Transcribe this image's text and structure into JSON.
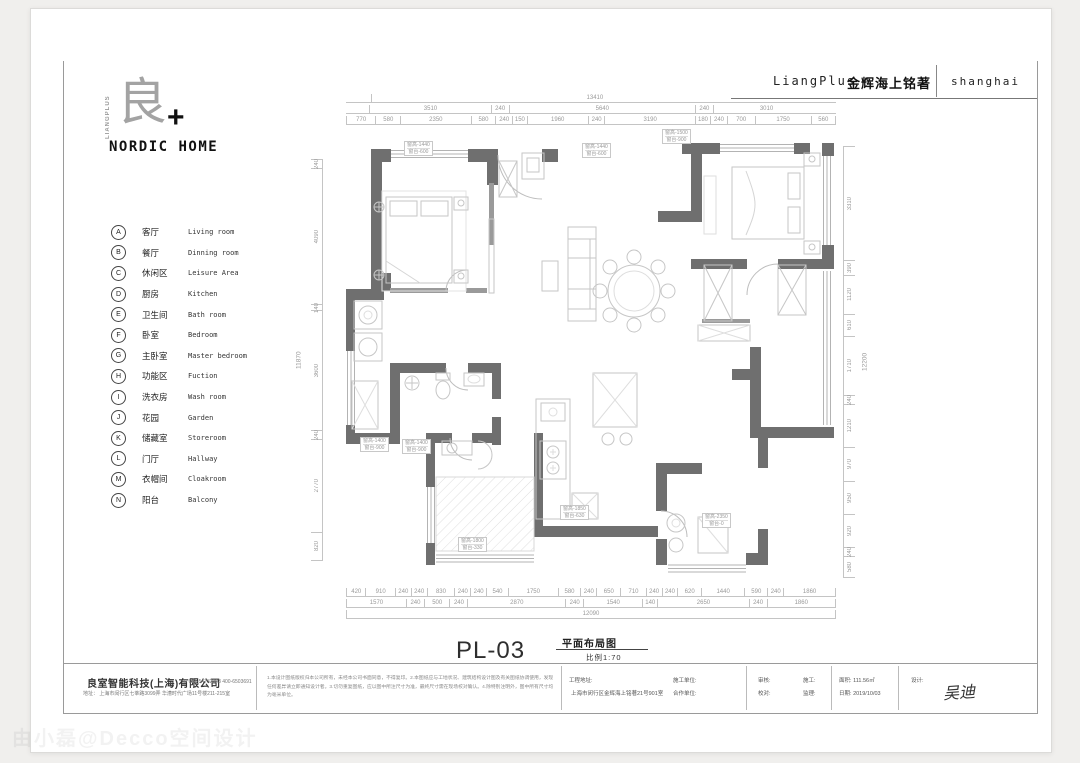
{
  "header": {
    "brand": "LiangPlus",
    "project": "金辉海上铭著",
    "city": "shanghai"
  },
  "logo": {
    "vertical": "LIANGPLUS",
    "glyph": "良",
    "plus": "+",
    "wordmark": "NORDIC HOME"
  },
  "legend": {
    "items": [
      {
        "key": "A",
        "cn": "客厅",
        "en": "Living room"
      },
      {
        "key": "B",
        "cn": "餐厅",
        "en": "Dinning room"
      },
      {
        "key": "C",
        "cn": "休闲区",
        "en": "Leisure Area"
      },
      {
        "key": "D",
        "cn": "厨房",
        "en": "Kitchen"
      },
      {
        "key": "E",
        "cn": "卫生间",
        "en": "Bath room"
      },
      {
        "key": "F",
        "cn": "卧室",
        "en": "Bedroom"
      },
      {
        "key": "G",
        "cn": "主卧室",
        "en": "Master bedroom"
      },
      {
        "key": "H",
        "cn": "功能区",
        "en": "Fuction"
      },
      {
        "key": "I",
        "cn": "洗衣房",
        "en": "Wash room"
      },
      {
        "key": "J",
        "cn": "花园",
        "en": "Garden"
      },
      {
        "key": "K",
        "cn": "储藏室",
        "en": "Storeroom"
      },
      {
        "key": "L",
        "cn": "门厅",
        "en": "Hallway"
      },
      {
        "key": "M",
        "cn": "衣帽间",
        "en": "Cloakroom"
      },
      {
        "key": "N",
        "cn": "阳台",
        "en": "Balcony"
      }
    ]
  },
  "plan": {
    "number": "PL-03",
    "name": "平面布局图",
    "scale": "比例1:70",
    "dims": {
      "top_overall": "13410",
      "top_mid": [
        "3510",
        "240",
        "5640",
        "240",
        "3010"
      ],
      "top_inner": [
        "770",
        "580",
        "2350",
        "580",
        "240",
        "150",
        "1960",
        "240",
        "3190",
        "180",
        "240",
        "700",
        "1750",
        "560"
      ],
      "bottom_inner": [
        "420",
        "910",
        "240",
        "240",
        "830",
        "240",
        "240",
        "540",
        "1750",
        "580",
        "240",
        "650",
        "710",
        "240",
        "240",
        "620",
        "1440",
        "590",
        "240",
        "1860"
      ],
      "bottom_mid": [
        "1570",
        "240",
        "500",
        "240",
        "2870",
        "240",
        "1540",
        "140",
        "2650",
        "240",
        "1860"
      ],
      "bottom_overall": "12090",
      "left_chain": [
        "240",
        "4090",
        "140",
        "3600",
        "240",
        "2770",
        "820"
      ],
      "left_overall": "11870",
      "right_chain": [
        "3310",
        "390",
        "1120",
        "610",
        "1710",
        "240",
        "1210",
        "970",
        "950",
        "920",
        "240",
        "580"
      ],
      "right_overall": "12200"
    },
    "window_tags": [
      {
        "l1": "窗高-1440",
        "l2": "窗台-600"
      },
      {
        "l1": "窗高-1440",
        "l2": "窗台-600"
      },
      {
        "l1": "窗高-1500",
        "l2": "窗台-900"
      },
      {
        "l1": "窗高-1400",
        "l2": "窗台-900"
      },
      {
        "l1": "窗高-1400",
        "l2": "窗台-900"
      },
      {
        "l1": "窗高-1800",
        "l2": "窗台-330"
      },
      {
        "l1": "窗高-1850",
        "l2": "窗台-630"
      },
      {
        "l1": "窗高-2350",
        "l2": "窗台-0"
      }
    ]
  },
  "footer": {
    "company": {
      "name": "良室智能科技(上海)有限公司",
      "tel": "021-54732293  400-6503691",
      "address": "地址： 上海市闵行区七莘路3099弄  华漕时代广场11号楼211-215室"
    },
    "notes": "1.本设计图纸版权归本公司所有，未经本公司书面同意，不得复印。2.本图纸应与工地状况、建筑结构设计图及有关图纸协调使用，发现任何差异请立即通知设计者。3.切勿重复图纸，应以图中所注尺寸为准，最终尺寸需在现场校对确认。4.除特别注明外，图中所有尺寸均为毫米单位。",
    "fields": {
      "site_label": "工程地址:",
      "site": "上海市闵行区金辉海上铭著21号901室",
      "builder_label": "施工单位:",
      "partner_label": "合作单位:",
      "audit_label": "审核:",
      "proof_label": "校对:",
      "construct_label": "施工:",
      "supervise_label": "监理:",
      "area_label": "面积:",
      "area": "111.56㎡",
      "date_label": "日期:",
      "date": "2019/10/03",
      "designer_label": "设计:",
      "designer": "吴迪"
    }
  },
  "watermark": "由小磊@Decco空间设计",
  "colors": {
    "wall": "#6f6f6f",
    "thin_wall": "#9a9a9a",
    "furniture": "#c6c6c6",
    "dim_text": "#9a9a9a"
  }
}
